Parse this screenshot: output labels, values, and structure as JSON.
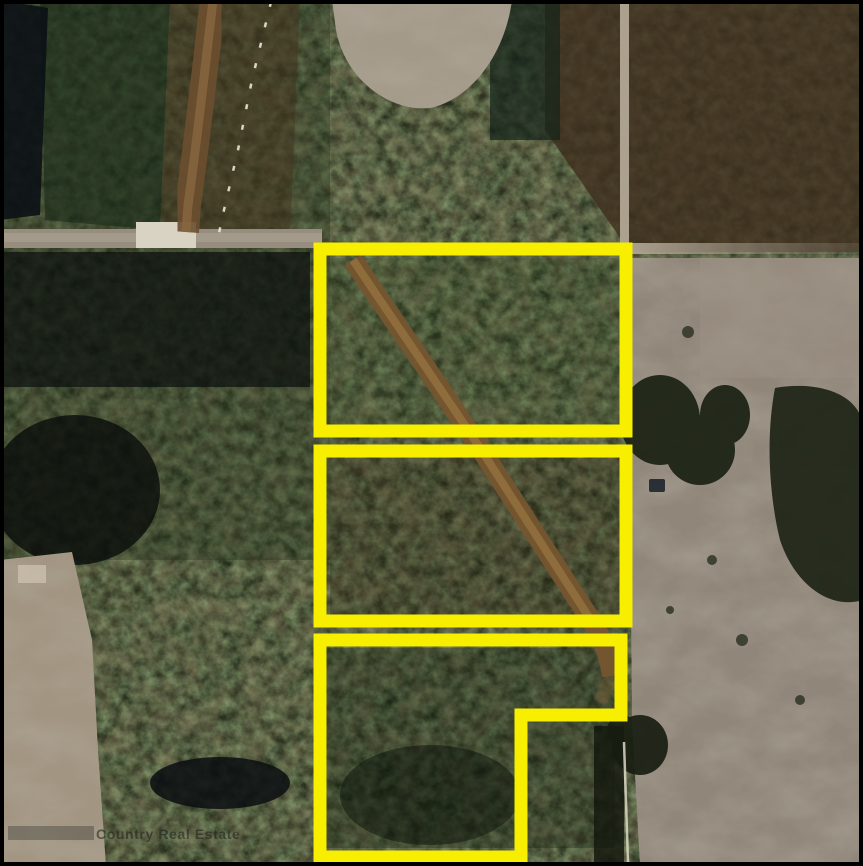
{
  "watermark": {
    "text": "Country Real Estate"
  },
  "colors": {
    "boundary": "#f7ee00",
    "frame": "#000000"
  }
}
